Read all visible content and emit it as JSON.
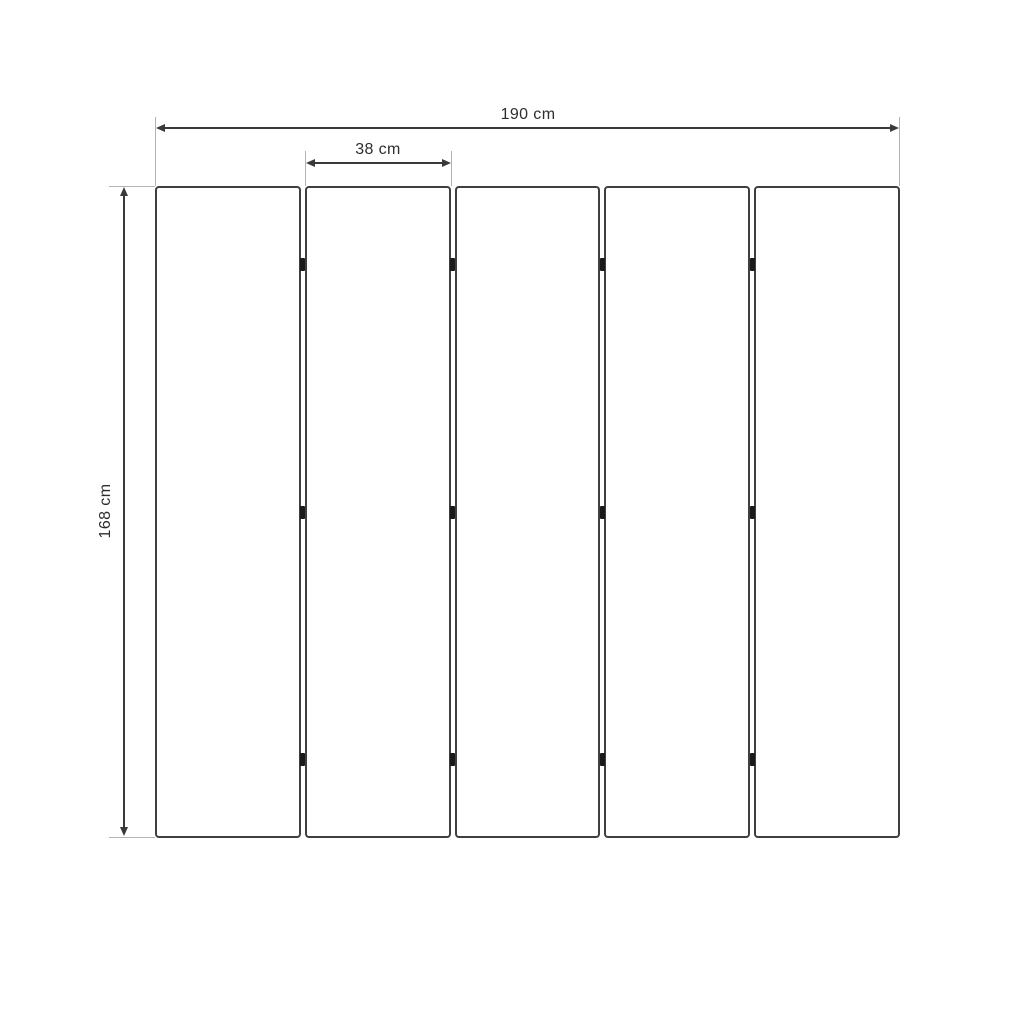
{
  "diagram": {
    "type": "dimensioned-technical-drawing",
    "subject": "five-panel folding screen, front view",
    "dimensions": {
      "total_width": {
        "label": "190 cm",
        "value_cm": 190
      },
      "panel_width": {
        "label": "38 cm",
        "value_cm": 38
      },
      "height": {
        "label": "168 cm",
        "value_cm": 168
      }
    },
    "panels": {
      "count": 5,
      "gap_count": 4,
      "hinges_per_gap": 3,
      "hinge_row_fractions": [
        0.12,
        0.5,
        0.88
      ]
    },
    "colors": {
      "background": "#ffffff",
      "outline": "#3f3f3f",
      "dimension_line": "#3a3a3a",
      "extension_line": "#b4b4b4",
      "hinge": "#1a1a1a",
      "text": "#2e2e2e"
    }
  }
}
